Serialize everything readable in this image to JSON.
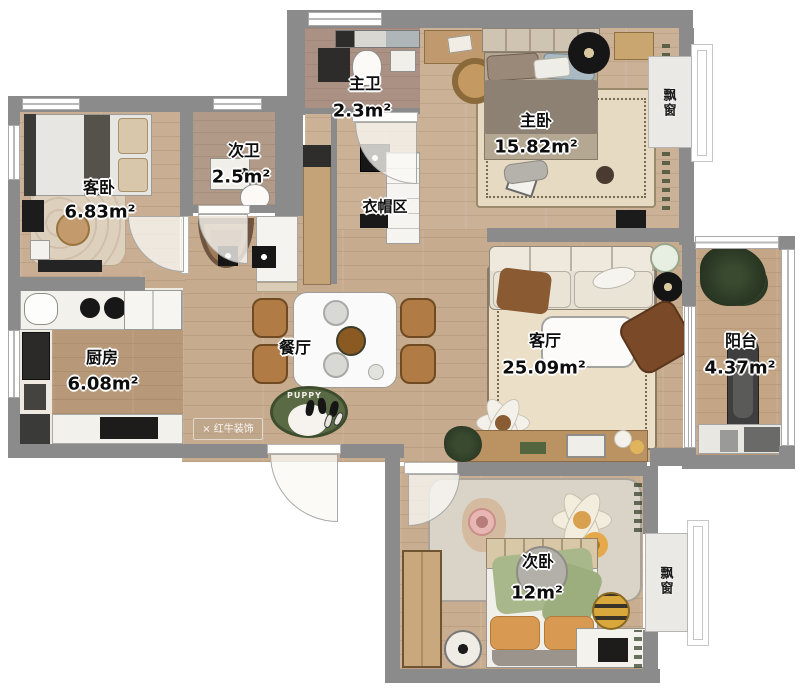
{
  "rooms": {
    "guest_bedroom": {
      "name": "客卧",
      "area": "6.83m²"
    },
    "second_bath": {
      "name": "次卫",
      "area": "2.5m²"
    },
    "master_bath": {
      "name": "主卫",
      "area": "2.3m²"
    },
    "master_bedroom": {
      "name": "主卧",
      "area": "15.82m²"
    },
    "cloakroom": {
      "name": "衣帽区",
      "area": ""
    },
    "kitchen": {
      "name": "厨房",
      "area": "6.08m²"
    },
    "dining": {
      "name": "餐厅",
      "area": ""
    },
    "living": {
      "name": "客厅",
      "area": "25.09m²"
    },
    "balcony": {
      "name": "阳台",
      "area": "4.37m²"
    },
    "second_bedroom": {
      "name": "次卧",
      "area": "12m²"
    },
    "bay_window_top": {
      "name": "飘窗"
    },
    "bay_window_bottom": {
      "name": "飘窗"
    }
  },
  "decor": {
    "puppy_rug_text": "PUPPY"
  },
  "branding": {
    "watermark_text": "红牛装饰",
    "logo_glyph": "×"
  },
  "colors": {
    "wall": "#8b8b8b",
    "wood_floor": "#c6ab8f",
    "kitchen_wood": "#b79878",
    "cream_rug": "#ecdfc7",
    "green_rug": "#5a6a44",
    "chair_wood": "#b07b44"
  }
}
